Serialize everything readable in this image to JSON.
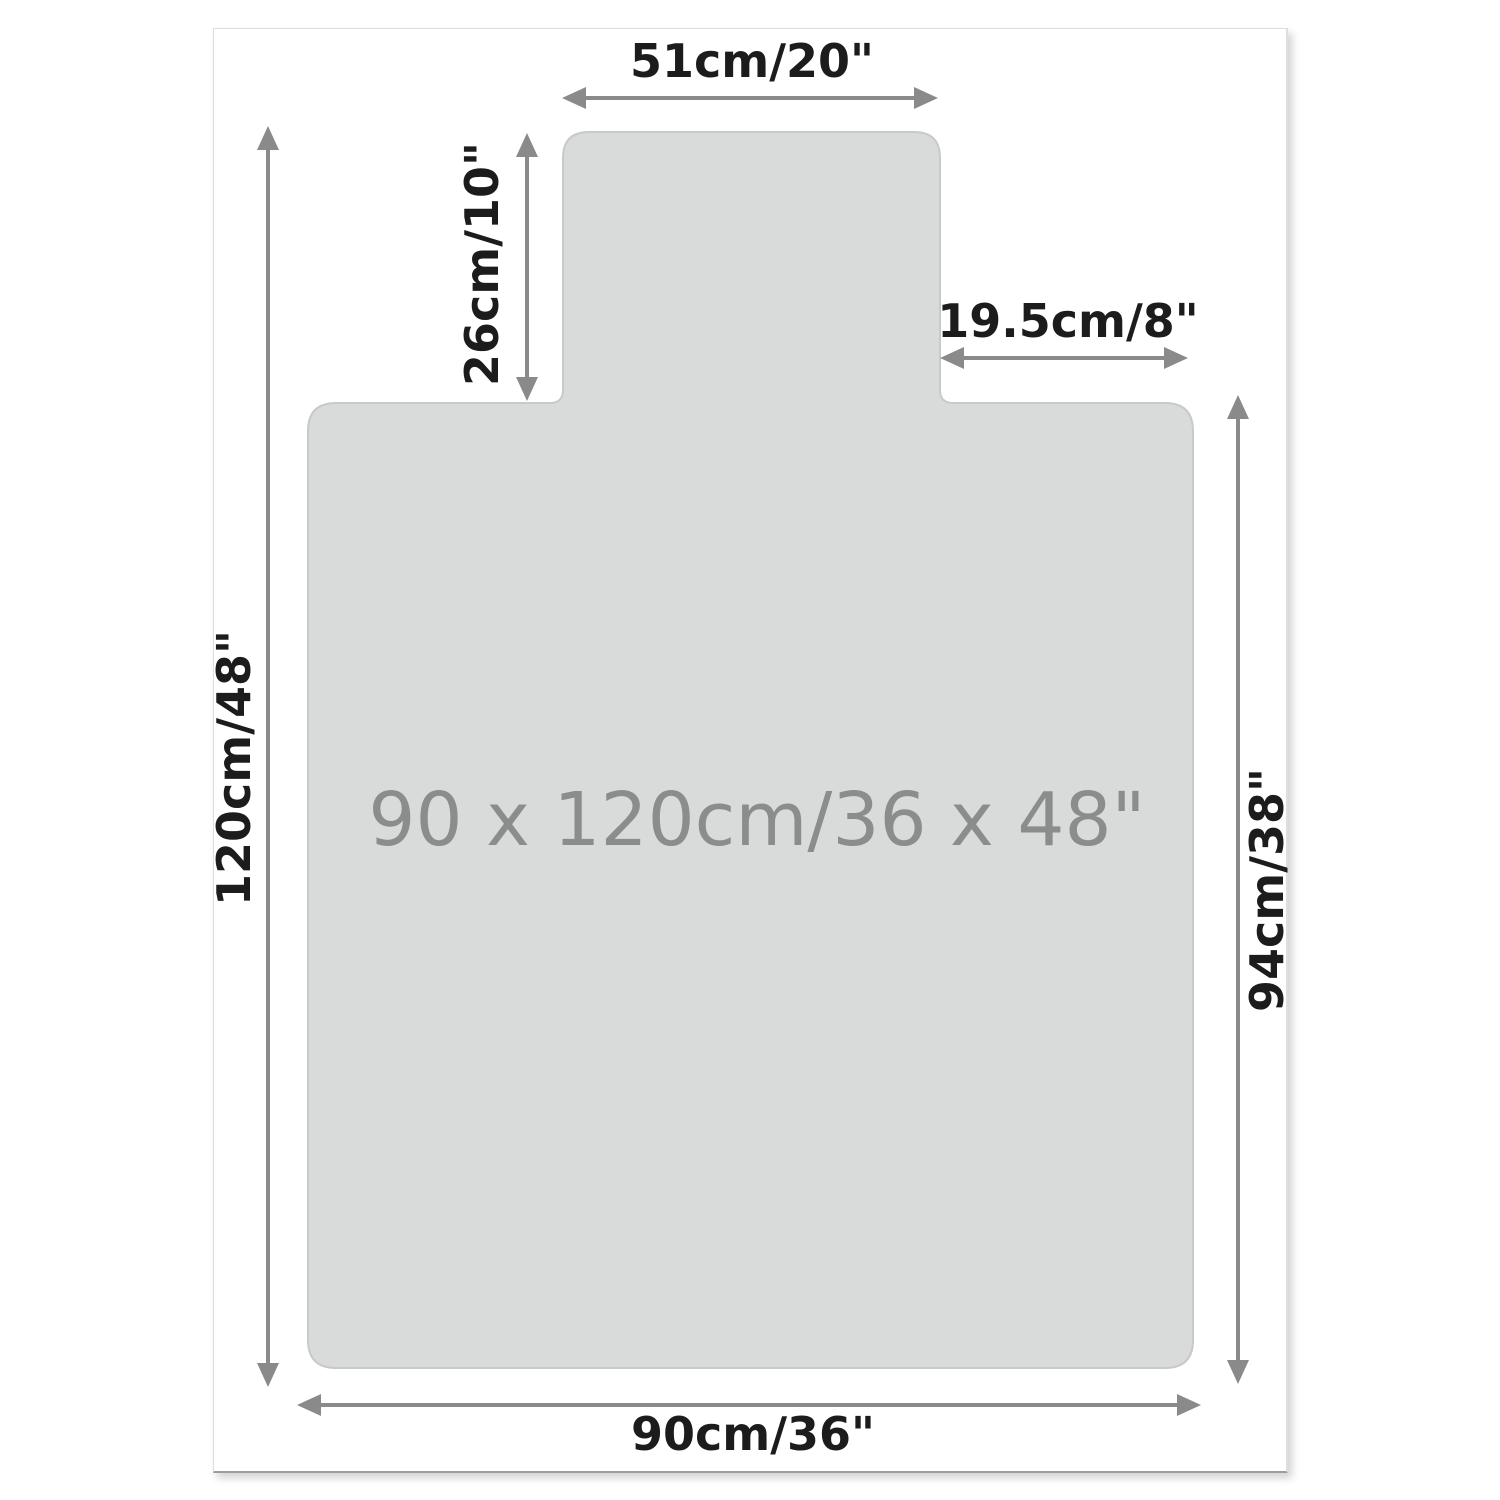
{
  "labels": {
    "top_width": "51cm/20\"",
    "lip_height": "26cm/10\"",
    "shoulder_width": "19.5cm/8\"",
    "left_height": "120cm/48\"",
    "right_height": "94cm/38\"",
    "bottom_width": "90cm/36\"",
    "center": "90 x 120cm/36 x 48\""
  },
  "colors": {
    "canvas": "#ffffff",
    "mat-fill": "#d9dada",
    "mat-edge": "#c8c9c9",
    "arrow": "#8a8a8a",
    "dim-text": "#1c1c1c",
    "center-text": "#8b8d8d",
    "frame-border": "#dedede",
    "frame-border-bottom": "#9c9c9c"
  }
}
